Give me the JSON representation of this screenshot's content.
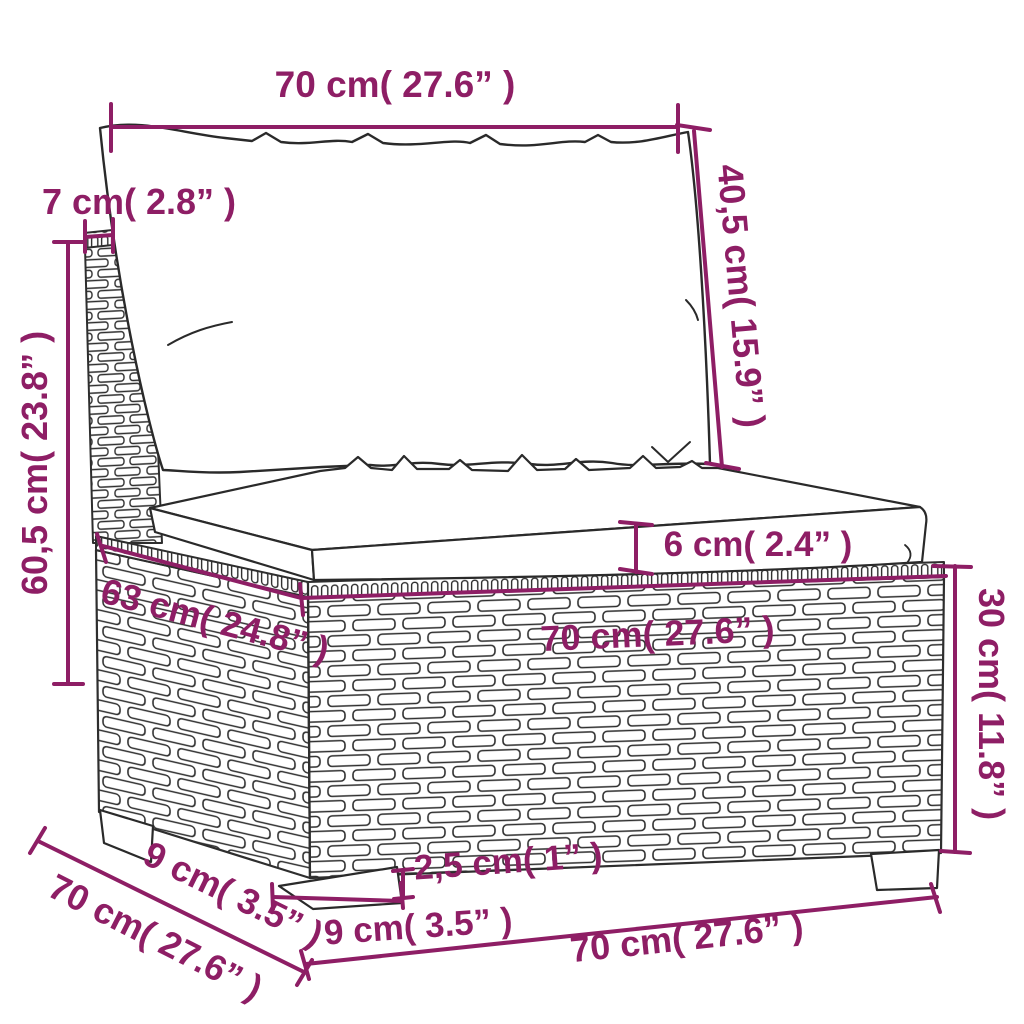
{
  "illustration": {
    "subject": "three-quarter line drawing of a poly rattan armless middle sofa section with back cushion and seat cushion",
    "parts": [
      "back-cushion",
      "seat-cushion",
      "rattan-back-post",
      "rattan-base-left-face",
      "rattan-base-front-face",
      "braided-top-rows",
      "legs"
    ]
  },
  "style": {
    "accent_color": "#8E1E65",
    "line_color": "#2E2E2E",
    "background_color": "#FFFFFF"
  },
  "dimensions": {
    "back_width": {
      "label": "70 cm( 27.6” )"
    },
    "back_cushion_height": {
      "label": "40,5 cm( 15.9” )"
    },
    "back_depth": {
      "label": "7 cm( 2.8” )"
    },
    "total_height": {
      "label": "60,5 cm( 23.8” )"
    },
    "seat_cushion_thickness": {
      "label": "6 cm( 2.4” )"
    },
    "seat_width": {
      "label": "70 cm( 27.6” )"
    },
    "seat_depth": {
      "label": "63 cm( 24.8” )"
    },
    "base_height": {
      "label": "30 cm( 11.8” )"
    },
    "leg_height": {
      "label": "2,5 cm( 1” )"
    },
    "leg_depth": {
      "label": "9 cm( 3.5” )"
    },
    "leg_side_offset": {
      "label": "9 cm( 3.5” )"
    },
    "side_depth": {
      "label": "70 cm( 27.6” )"
    },
    "bottom_width": {
      "label": "70 cm( 27.6” )"
    }
  }
}
